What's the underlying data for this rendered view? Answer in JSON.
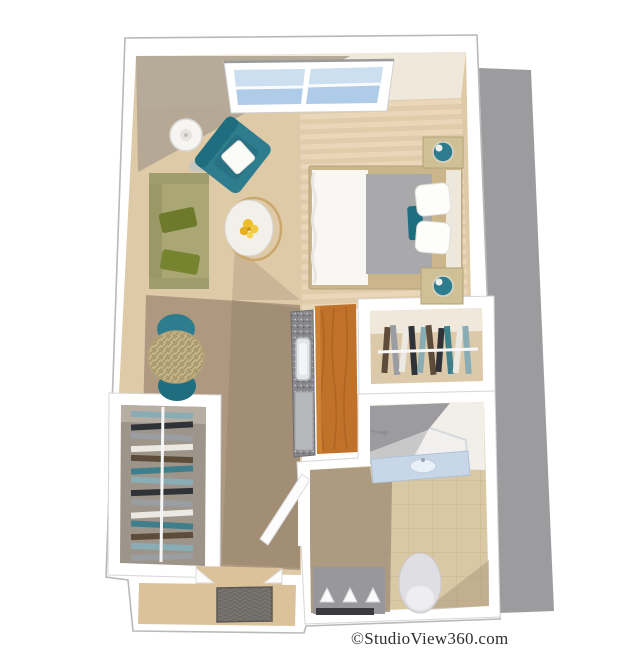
{
  "watermark": "©StudioView360.com",
  "scene": {
    "type": "3d-floorplan-render",
    "description": "Top-down 3D dollhouse rendering of a studio apartment unit with drop shadow on the right",
    "window_count": 1,
    "rooms": [
      {
        "name": "living-area",
        "furniture": [
          "olive-sofa",
          "teal-accent-armchair",
          "white-floor-lamp",
          "round-coffee-table-with-flowers"
        ]
      },
      {
        "name": "sleeping-area",
        "furniture": [
          "bed-with-white-duvet-and-gray-blanket",
          "nightstand-with-teal-lamp",
          "nightstand-with-teal-lamp"
        ]
      },
      {
        "name": "dining-nook",
        "furniture": [
          "round-rattan-table",
          "teal-dining-chair",
          "teal-dining-chair"
        ]
      },
      {
        "name": "kitchenette",
        "furniture": [
          "granite-counter-with-sink",
          "tall-wood-cabinet",
          "under-counter-appliance"
        ]
      },
      {
        "name": "walk-in-closet",
        "furniture": [
          "clothes-rod-with-hanging-clothes"
        ]
      },
      {
        "name": "side-closet",
        "furniture": [
          "clothes-rod-with-hanging-clothes"
        ]
      },
      {
        "name": "bathroom",
        "furniture": [
          "corner-shower-with-glass-door",
          "vanity-with-sink",
          "toilet",
          "towel-shelf"
        ]
      },
      {
        "name": "entry-hall",
        "furniture": [
          "doormat"
        ]
      }
    ]
  },
  "colors": {
    "bg": "#ffffff",
    "dropShadow": "#9c9c9f",
    "wallWhite": "#ffffff",
    "wallStroke": "#b9b9b9",
    "innerWallStroke": "#d6d6d6",
    "wallBand": "#efe8db",
    "wallShadow": "#b2a695",
    "carpet": "#dfcaa8",
    "carpetLight": "#ead7b9",
    "carpetStripe": "#e0cbaa",
    "hallShadow": "#a9957d",
    "hallShadowDark": "#9d8971",
    "glass": "#aecbe8",
    "glassLight": "#d3e4f3",
    "teal": "#2e7d8e",
    "tealDark": "#1f6e80",
    "olive": "#aaa775",
    "oliveDark": "#9b9867",
    "olivePillow": "#6d7a2c",
    "olivePillow2": "#76842f",
    "lampWhite": "#f6f5f2",
    "tableGold": "#c9a86a",
    "tableTop": "#f2f0ea",
    "flowerYellow": "#eebd2a",
    "frameWood": "#cbb68c",
    "duvet": "#f8f7f3",
    "blanketGray": "#a9a9ac",
    "pillowWhite": "#fdfdfc",
    "headboard": "#eee8dc",
    "nightstand": "#cfc096",
    "counterGray": "#87878b",
    "sinkWhite": "#e2e6e9",
    "applianceGray": "#b6b7bb",
    "cabinetOrange": "#c0712a",
    "cabinetGrain": "#9d5a1e",
    "rattanBase": "#c6b588",
    "rattanLine": "#a6956a",
    "closetDim": "#9d948a",
    "closetFloor": "#dbc9a9",
    "tileFloor": "#d9c8a4",
    "tileGrout": "#c2ad86",
    "tileShadow": "#a5937b",
    "showerGray": "#9c9ca0",
    "showerGrayLight": "#b8b8bc",
    "vanityBlue": "#c7d7e8",
    "toiletWhite": "#dfdfe3",
    "shelfGray": "#98989c",
    "towelWhite": "#fafafa",
    "shelfBar": "#3b3b3d",
    "entryFloor": "#dcc29b",
    "doormat": "#6e6a66",
    "clothes1": "#8aacb4",
    "clothes2": "#2f3338",
    "clothes3": "#9a9da2",
    "clothes4": "#ece9e2",
    "clothes5": "#5d4c3a",
    "clothes6": "#3f7e8b",
    "watermarkColor": "#2e2e2e"
  }
}
